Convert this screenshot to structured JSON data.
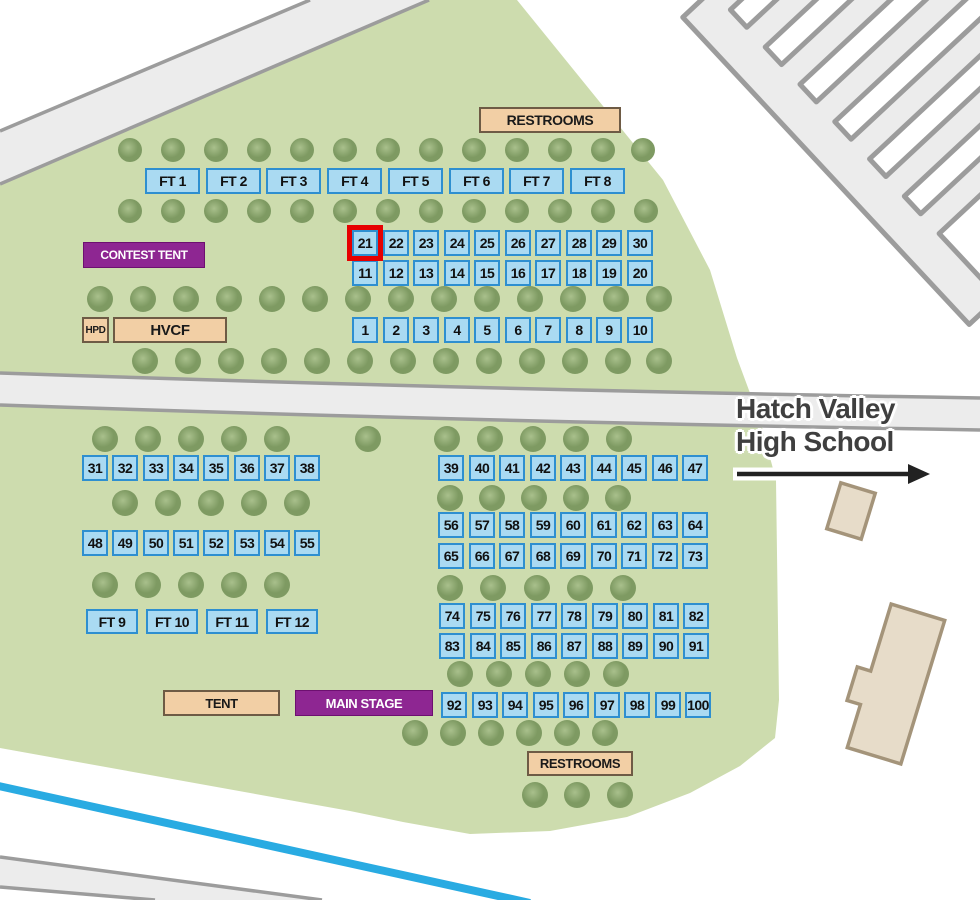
{
  "map": {
    "school_label": {
      "line1": "Hatch Valley",
      "line2": "High School"
    },
    "highlighted_booth": "21",
    "booth_size": 26,
    "colors": {
      "grass": "#cddcae",
      "tree_light": "#a9c08c",
      "tree_dark": "#7e9a62",
      "booth_fill": "#aadaf2",
      "booth_border": "#2e8fd0",
      "booth_text": "#111111",
      "tan_fill": "#f2cfa5",
      "tan_border": "#6e5b45",
      "purple_fill": "#8e2692",
      "purple_text": "#ffffff",
      "road_fill": "#ececec",
      "road_border": "#9c9c9c",
      "canal": "#29abe2",
      "highlight": "#e60000",
      "building_fill": "#e7dcc9",
      "building_border": "#a4947a",
      "school_text": "#3f3f3f",
      "arrow": "#222222"
    },
    "facilities": [
      {
        "id": "restrooms-top",
        "label": "RESTROOMS",
        "style": "tan",
        "x": 479,
        "y": 107,
        "w": 142,
        "h": 26,
        "font": 14
      },
      {
        "id": "contest-tent",
        "label": "CONTEST TENT",
        "style": "purple",
        "x": 83,
        "y": 242,
        "w": 122,
        "h": 26,
        "font": 12
      },
      {
        "id": "hpd",
        "label": "HPD",
        "style": "tan",
        "x": 82,
        "y": 317,
        "w": 27,
        "h": 26,
        "font": 10
      },
      {
        "id": "hvcf",
        "label": "HVCF",
        "style": "tan",
        "x": 113,
        "y": 317,
        "w": 114,
        "h": 26,
        "font": 15
      },
      {
        "id": "tent",
        "label": "TENT",
        "style": "tan",
        "x": 163,
        "y": 690,
        "w": 117,
        "h": 26,
        "font": 13
      },
      {
        "id": "main-stage",
        "label": "MAIN STAGE",
        "style": "purple",
        "x": 295,
        "y": 690,
        "w": 138,
        "h": 26,
        "font": 13
      },
      {
        "id": "restrooms-bottom",
        "label": "RESTROOMS",
        "style": "tan",
        "x": 527,
        "y": 751,
        "w": 106,
        "h": 25,
        "font": 13
      }
    ],
    "food_tents": [
      {
        "label": "FT 1",
        "x": 145,
        "y": 168,
        "w": 55,
        "h": 26
      },
      {
        "label": "FT 2",
        "x": 206,
        "y": 168,
        "w": 55,
        "h": 26
      },
      {
        "label": "FT 3",
        "x": 266,
        "y": 168,
        "w": 55,
        "h": 26
      },
      {
        "label": "FT 4",
        "x": 327,
        "y": 168,
        "w": 55,
        "h": 26
      },
      {
        "label": "FT 5",
        "x": 388,
        "y": 168,
        "w": 55,
        "h": 26
      },
      {
        "label": "FT 6",
        "x": 449,
        "y": 168,
        "w": 55,
        "h": 26
      },
      {
        "label": "FT 7",
        "x": 509,
        "y": 168,
        "w": 55,
        "h": 26
      },
      {
        "label": "FT 8",
        "x": 570,
        "y": 168,
        "w": 55,
        "h": 26
      },
      {
        "label": "FT 9",
        "x": 86,
        "y": 609,
        "w": 52,
        "h": 25
      },
      {
        "label": "FT 10",
        "x": 146,
        "y": 609,
        "w": 52,
        "h": 25
      },
      {
        "label": "FT 11",
        "x": 206,
        "y": 609,
        "w": 52,
        "h": 25
      },
      {
        "label": "FT 12",
        "x": 266,
        "y": 609,
        "w": 52,
        "h": 25
      }
    ],
    "booth_rows": [
      {
        "y": 230,
        "x": 352,
        "pitch": 30.5,
        "labels": [
          "21",
          "22",
          "23",
          "24",
          "25",
          "26",
          "27",
          "28",
          "29",
          "30"
        ]
      },
      {
        "y": 260,
        "x": 352,
        "pitch": 30.5,
        "labels": [
          "11",
          "12",
          "13",
          "14",
          "15",
          "16",
          "17",
          "18",
          "19",
          "20"
        ]
      },
      {
        "y": 317,
        "x": 352,
        "pitch": 30.5,
        "labels": [
          "1",
          "2",
          "3",
          "4",
          "5",
          "6",
          "7",
          "8",
          "9",
          "10"
        ]
      },
      {
        "y": 455,
        "x": 82,
        "pitch": 30.3,
        "labels": [
          "31",
          "32",
          "33",
          "34",
          "35",
          "36",
          "37",
          "38"
        ]
      },
      {
        "y": 530,
        "x": 82,
        "pitch": 30.3,
        "labels": [
          "48",
          "49",
          "50",
          "51",
          "52",
          "53",
          "54",
          "55"
        ]
      },
      {
        "y": 455,
        "x": 438,
        "pitch": 30.5,
        "labels": [
          "39",
          "40",
          "41",
          "42",
          "43",
          "44",
          "45",
          "46",
          "47"
        ]
      },
      {
        "y": 512,
        "x": 438,
        "pitch": 30.5,
        "labels": [
          "56",
          "57",
          "58",
          "59",
          "60",
          "61",
          "62",
          "63",
          "64"
        ]
      },
      {
        "y": 543,
        "x": 438,
        "pitch": 30.5,
        "labels": [
          "65",
          "66",
          "67",
          "68",
          "69",
          "70",
          "71",
          "72",
          "73"
        ]
      },
      {
        "y": 603,
        "x": 439,
        "pitch": 30.5,
        "labels": [
          "74",
          "75",
          "76",
          "77",
          "78",
          "79",
          "80",
          "81",
          "82"
        ]
      },
      {
        "y": 633,
        "x": 439,
        "pitch": 30.5,
        "labels": [
          "83",
          "84",
          "85",
          "86",
          "87",
          "88",
          "89",
          "90",
          "91"
        ]
      },
      {
        "y": 692,
        "x": 441,
        "pitch": 30.5,
        "labels": [
          "92",
          "93",
          "94",
          "95",
          "96",
          "97",
          "98",
          "99",
          "100"
        ]
      }
    ],
    "trees": [
      {
        "y": 150,
        "r": 12,
        "xs": [
          130,
          173,
          216,
          259,
          302,
          345,
          388,
          431,
          474,
          517,
          560,
          603,
          643
        ]
      },
      {
        "y": 211,
        "r": 12,
        "xs": [
          130,
          173,
          216,
          259,
          302,
          345,
          388,
          431,
          474,
          517,
          560,
          603,
          646
        ]
      },
      {
        "y": 299,
        "r": 13,
        "xs": [
          100,
          143,
          186,
          229,
          272,
          315,
          358,
          401,
          444,
          487,
          530,
          573,
          616,
          659
        ]
      },
      {
        "y": 361,
        "r": 13,
        "xs": [
          145,
          188,
          231,
          274,
          317,
          360,
          403,
          446,
          489,
          532,
          575,
          618,
          659
        ]
      },
      {
        "y": 439,
        "r": 13,
        "xs": [
          105,
          148,
          191,
          234,
          277,
          368,
          447,
          490,
          533,
          576,
          619
        ]
      },
      {
        "y": 503,
        "r": 13,
        "xs": [
          125,
          168,
          211,
          254,
          297
        ]
      },
      {
        "y": 498,
        "r": 13,
        "xs": [
          450,
          492,
          534,
          576,
          618
        ]
      },
      {
        "y": 585,
        "r": 13,
        "xs": [
          105,
          148,
          191,
          234,
          277
        ]
      },
      {
        "y": 588,
        "r": 13,
        "xs": [
          450,
          493,
          537,
          580,
          623
        ]
      },
      {
        "y": 674,
        "r": 13,
        "xs": [
          460,
          499,
          538,
          577,
          616
        ]
      },
      {
        "y": 733,
        "r": 13,
        "xs": [
          415,
          453,
          491,
          529,
          567,
          605
        ]
      },
      {
        "y": 795,
        "r": 13,
        "xs": [
          535,
          577,
          620
        ]
      }
    ]
  }
}
